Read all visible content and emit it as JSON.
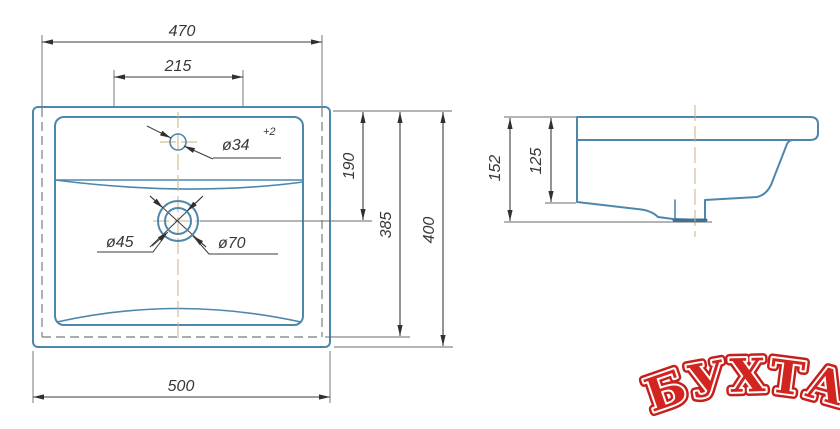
{
  "front_view": {
    "dims": {
      "width_top": "470",
      "tap_spacing": "215",
      "faucet_hole_diameter": "ø34",
      "faucet_hole_tolerance": "+2",
      "depth_to_drain": "190",
      "depth_inner": "385",
      "depth_total": "400",
      "width_bottom": "500",
      "drain_inner_diameter": "ø45",
      "drain_outer_diameter": "ø70"
    }
  },
  "side_view": {
    "dims": {
      "height_total": "152",
      "height_basin": "125"
    }
  },
  "watermark": {
    "text": "БУХТА",
    "color": "#d2251f"
  },
  "colors": {
    "outline_blue": "#4d87ac",
    "dimension_gray": "#3b3b3d",
    "centerline_tan": "#c9b183",
    "hidden_dash_gray": "#7b7b7d",
    "fill_tint": "#eff5f9",
    "watermark_red": "#d2251f",
    "background": "#ffffff"
  }
}
